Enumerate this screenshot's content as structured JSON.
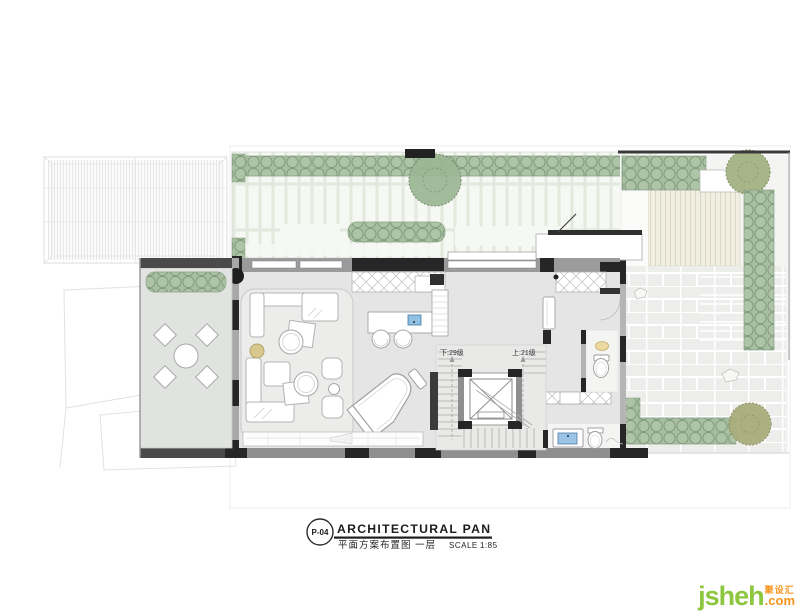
{
  "title_block": {
    "page_number": "P-04",
    "title_en": "ARCHITECTURAL PAN",
    "title_cn": "平面方案布置图  一层",
    "scale_label": "SCALE",
    "scale_value": "1:85"
  },
  "plan": {
    "labels": {
      "stairs_down": "下:29级",
      "stairs_up": "上:21级"
    }
  },
  "watermark": {
    "brand": "jsheh",
    "tld": ".com",
    "cn_name": "聚设汇"
  },
  "colors": {
    "hedge_green": "#a7bfa0",
    "tree_green": "#9cb794",
    "olive_tree": "#a9ad7c",
    "deck_beige": "#f1eee2",
    "garden_paving": "#e9eee4",
    "wall_dark": "#262626",
    "wall_gray": "#8f8f8f",
    "floor_gray": "#e4e5e4",
    "sink_blue": "#8fc1e3",
    "brass_gold": "#d9c88e",
    "watermark_green": "#8dc63f",
    "watermark_orange": "#f7941d"
  }
}
